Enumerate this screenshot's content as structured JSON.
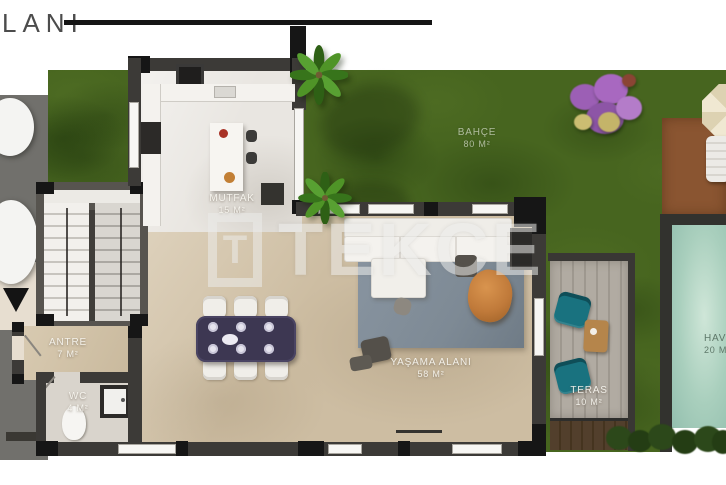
{
  "page": {
    "title_fragment": "LANI"
  },
  "watermark": {
    "logo_letter": "T",
    "brand": "TEKCE"
  },
  "rooms": {
    "garden": {
      "name": "BAHÇE",
      "area": "80 M²"
    },
    "kitchen": {
      "name": "MUTFAK",
      "area": "15 M²"
    },
    "living_area": {
      "name": "YAŞAMA ALANI",
      "area": "58 M²"
    },
    "hallway": {
      "name": "ANTRE",
      "area": "7 M²"
    },
    "wc": {
      "name": "WC",
      "area": "4 M²"
    },
    "terrace": {
      "name": "TERAS",
      "area": "10 M²"
    },
    "pool": {
      "name": "HAVUZ",
      "area": "20 M²"
    }
  },
  "colors": {
    "wall": "#3c3a37",
    "wall_post": "#161616",
    "lawn": "#47651f",
    "pool_water": "#a9cfbd",
    "patio": "#8a5531",
    "deck_light": "#b1aba2",
    "deck_dark": "#523f2c",
    "living_floor": "#cdbda2",
    "kitchen_floor": "#e9e6e1",
    "rug": "#7e8a95",
    "pouf": "#c07a3a",
    "dining_table": "#3d3752",
    "accent_chair": "#19727f",
    "driveway": "#71706c",
    "walkway": "#e7ded0",
    "watermark": "#ececea"
  }
}
